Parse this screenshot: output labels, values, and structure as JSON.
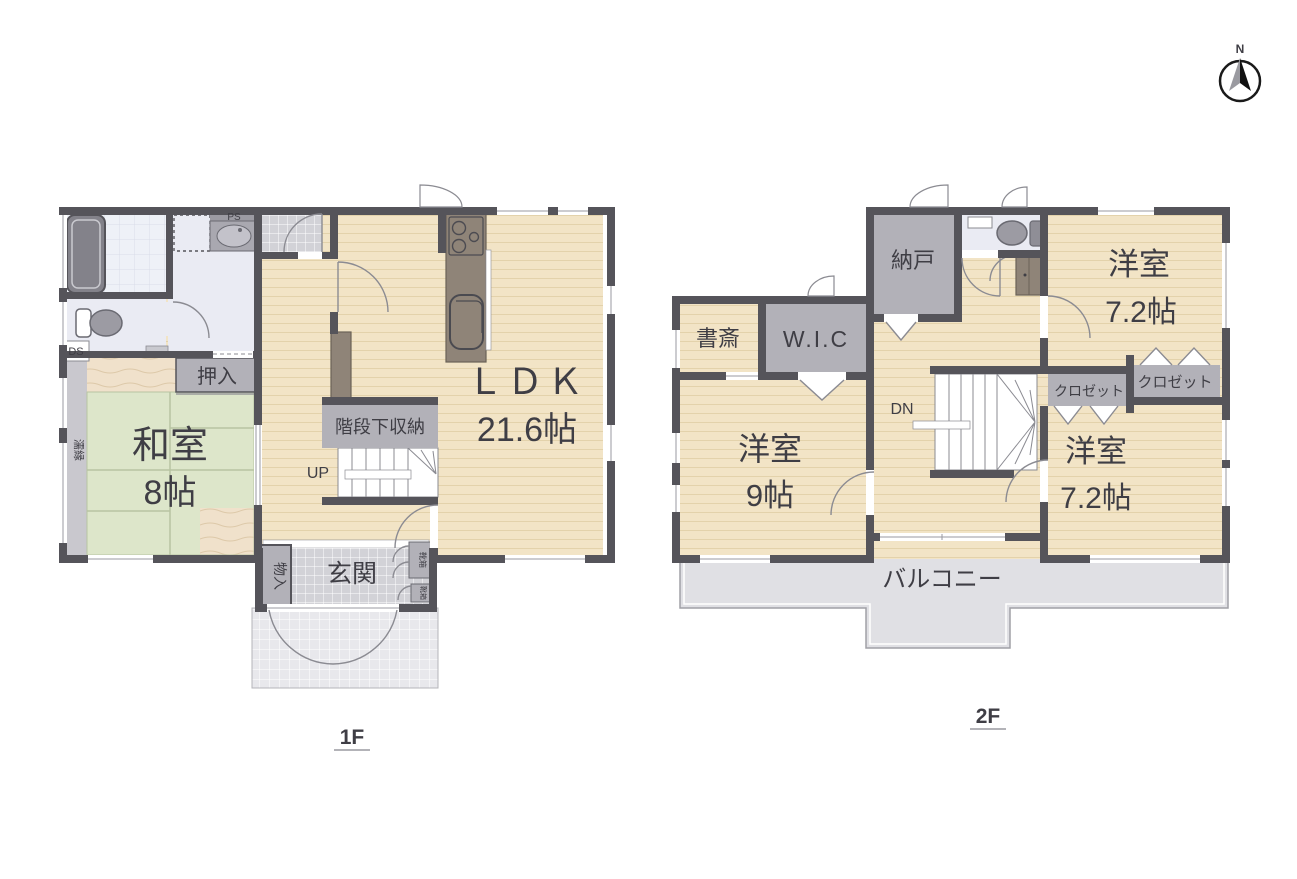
{
  "palette": {
    "wall": "#55545a",
    "wood_floor": "#f2e4c6",
    "wood_stripe": "#e3d2ab",
    "tatami": "#dde6ca",
    "tatami_line": "#b8c4a2",
    "gray_room": "#b2b1b8",
    "genkan_tile": "#d2d2d7",
    "porch_tile": "#e8e8ec",
    "bath_floor": "#eef1f7",
    "toilet_floor": "#eaebf3",
    "balcony": "#e0e0e4",
    "kitchen_counter": "#8f8478",
    "text": "#3f3e45"
  },
  "compass": {
    "north_label": "N"
  },
  "floor1": {
    "title": "1F",
    "labels": {
      "ldk": "ＬＤＫ",
      "ldk_size": "21.6帖",
      "washitsu": "和室",
      "washitsu_size": "8帖",
      "genkan": "玄関",
      "oshiire": "押入",
      "stair_storage": "階段下収納",
      "up": "UP",
      "monoire": "物入",
      "nureen": "濡縁",
      "ps": "PS",
      "ds": "DS",
      "shoe_box_upper": "靴箱",
      "shoe_box_lower": "靴箱"
    }
  },
  "floor2": {
    "title": "2F",
    "labels": {
      "nando": "納戸",
      "shosai": "書斎",
      "wic": "W.I.C",
      "room9": "洋室",
      "room9_size": "9帖",
      "room72a": "洋室",
      "room72a_size": "7.2帖",
      "room72b": "洋室",
      "room72b_size": "7.2帖",
      "closet_a": "クロゼット",
      "closet_b": "クロゼット",
      "dn": "DN",
      "balcony": "バルコニー"
    }
  }
}
